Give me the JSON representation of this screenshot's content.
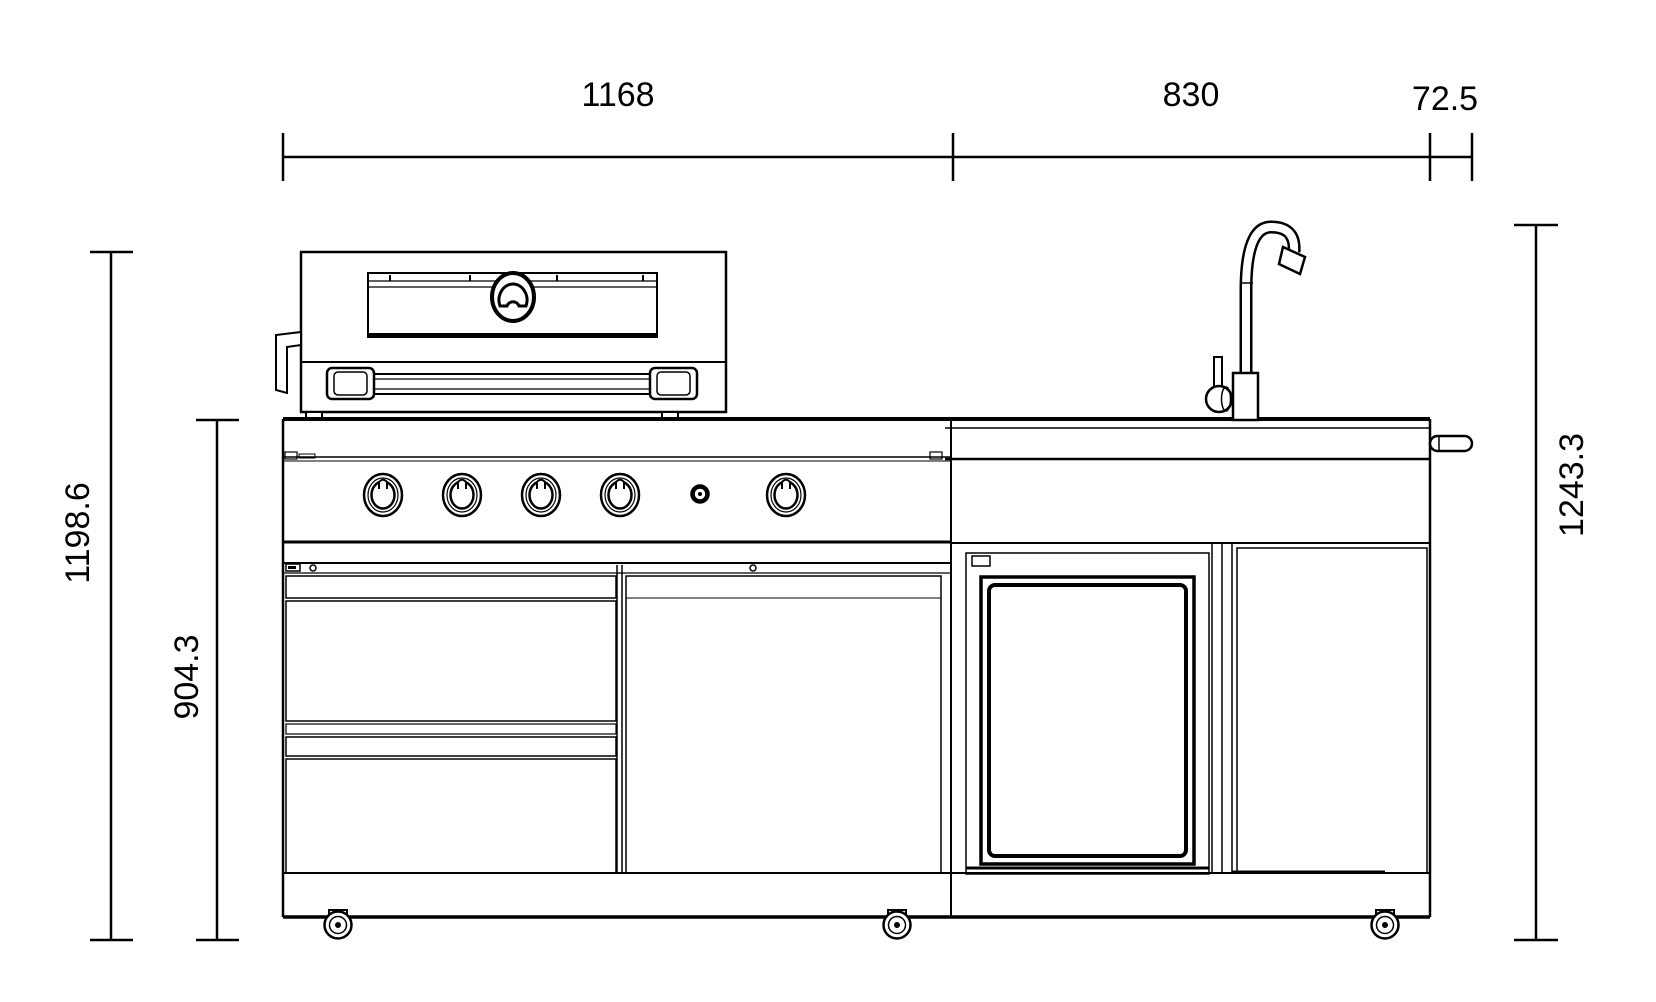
{
  "drawing": {
    "background_color": "#ffffff",
    "line_color": "#000000",
    "dimension_labels": {
      "top": [
        {
          "label": "1168"
        },
        {
          "label": "830"
        },
        {
          "label": "72.5"
        }
      ],
      "left": [
        {
          "label": "1198.6"
        },
        {
          "label": "904.3"
        }
      ],
      "right": [
        {
          "label": "1243.3"
        }
      ]
    }
  }
}
